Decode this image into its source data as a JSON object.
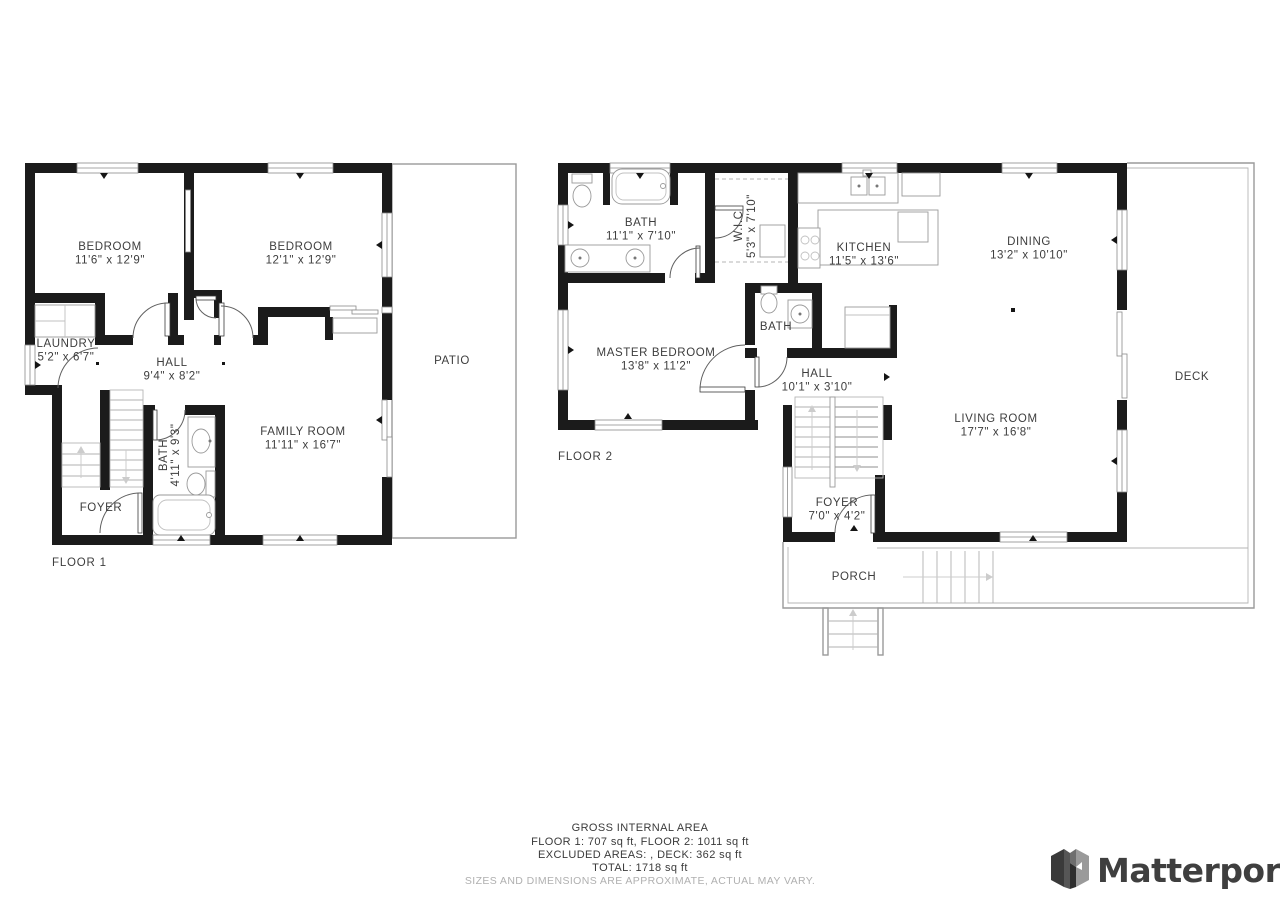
{
  "floor1": {
    "title": "FLOOR 1",
    "bedroom1": {
      "name": "BEDROOM",
      "dims": "11'6\" x 12'9\""
    },
    "bedroom2": {
      "name": "BEDROOM",
      "dims": "12'1\" x 12'9\""
    },
    "laundry": {
      "name": "LAUNDRY",
      "dims": "5'2\" x 6'7\""
    },
    "hall": {
      "name": "HALL",
      "dims": "9'4\" x 8'2\""
    },
    "bath": {
      "name": "BATH",
      "dims": "4'11\" x 9'3\""
    },
    "family_room": {
      "name": "FAMILY ROOM",
      "dims": "11'11\" x 16'7\""
    },
    "foyer": {
      "name": "FOYER"
    },
    "patio": {
      "name": "PATIO"
    }
  },
  "floor2": {
    "title": "FLOOR 2",
    "bath": {
      "name": "BATH",
      "dims": "11'1\" x 7'10\""
    },
    "wic": {
      "name": "W.I.C",
      "dims": "5'3\" x 7'10\""
    },
    "kitchen": {
      "name": "KITCHEN",
      "dims": "11'5\" x 13'6\""
    },
    "dining": {
      "name": "DINING",
      "dims": "13'2\" x 10'10\""
    },
    "master_bedroom": {
      "name": "MASTER BEDROOM",
      "dims": "13'8\" x 11'2\""
    },
    "bath_small": {
      "name": "BATH"
    },
    "hall": {
      "name": "HALL",
      "dims": "10'1\" x 3'10\""
    },
    "living_room": {
      "name": "LIVING ROOM",
      "dims": "17'7\" x 16'8\""
    },
    "foyer": {
      "name": "FOYER",
      "dims": "7'0\" x 4'2\""
    },
    "porch": {
      "name": "PORCH"
    },
    "deck": {
      "name": "DECK"
    }
  },
  "footer": {
    "line1": "GROSS INTERNAL AREA",
    "line2": "FLOOR 1: 707 sq ft, FLOOR 2: 1011 sq ft",
    "line3": "EXCLUDED AREAS: , DECK: 362 sq ft",
    "line4": "TOTAL: 1718 sq ft",
    "disclaimer": "SIZES AND DIMENSIONS ARE APPROXIMATE, ACTUAL MAY VARY."
  },
  "brand": {
    "name": "Matterport"
  },
  "colors": {
    "wall": "#1b1b1b",
    "fixture": "#9a9a9a",
    "text": "#3d3d3d",
    "muted": "#b0b0b0"
  }
}
